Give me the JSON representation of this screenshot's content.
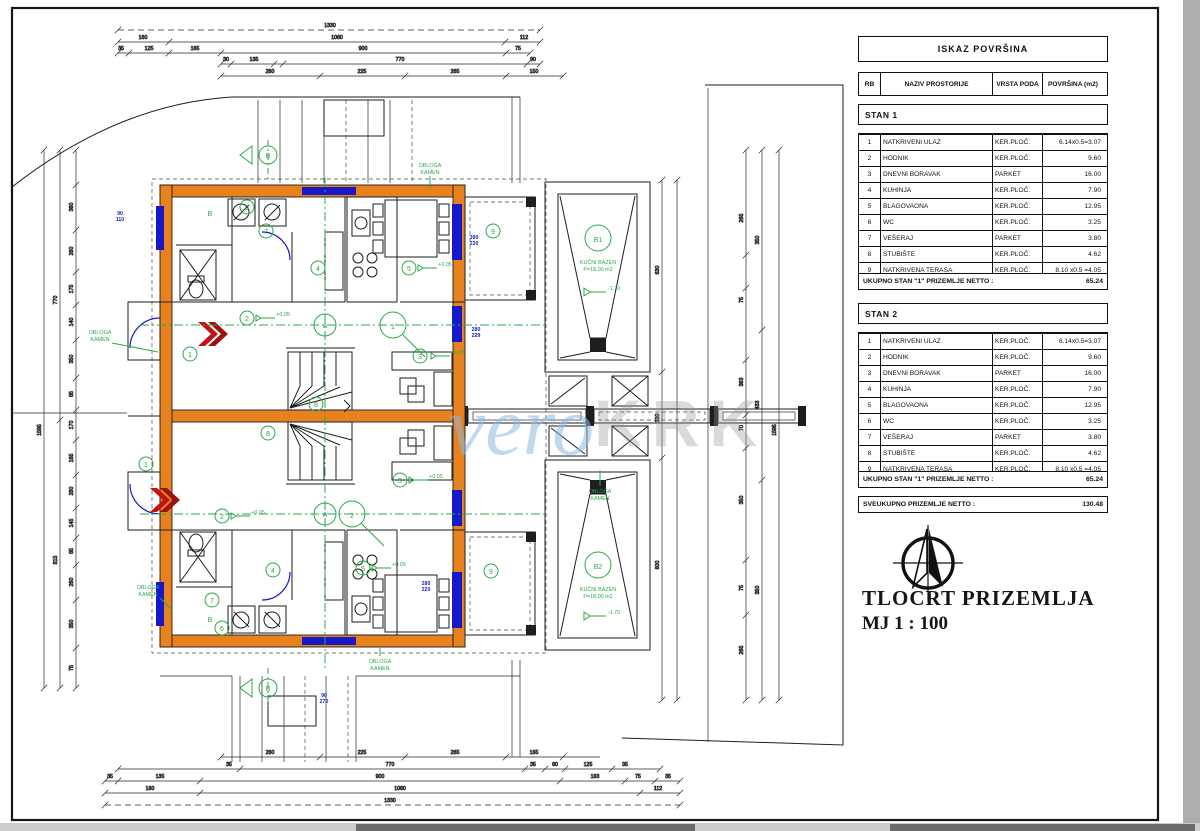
{
  "tables": {
    "title": "ISKAZ POVRŠINA",
    "columns": [
      "RB",
      "NAZIV PROSTORIJE",
      "VRSTA PODA",
      "POVRŠINA (m2)"
    ],
    "stan1": {
      "label": "STAN 1",
      "rows": [
        {
          "rb": "1",
          "name": "NATKRIVENI ULAZ",
          "floor": "KER.PLOČ.",
          "area": "6.14x0.5=3.07"
        },
        {
          "rb": "2",
          "name": "HODNIK",
          "floor": "KER.PLOČ.",
          "area": "9.60"
        },
        {
          "rb": "3",
          "name": "DNEVNI BORAVAK",
          "floor": "PARKET",
          "area": "16.00"
        },
        {
          "rb": "4",
          "name": "KUHINJA",
          "floor": "KER.PLOČ.",
          "area": "7.90"
        },
        {
          "rb": "5",
          "name": "BLAGOVAONA",
          "floor": "KER.PLOČ.",
          "area": "12.95"
        },
        {
          "rb": "6",
          "name": "WC",
          "floor": "KER.PLOČ.",
          "area": "3.25"
        },
        {
          "rb": "7",
          "name": "VEŠERAJ",
          "floor": "PARKET",
          "area": "3.80"
        },
        {
          "rb": "8",
          "name": "STUBIŠTE",
          "floor": "KER.PLOČ.",
          "area": "4.62"
        },
        {
          "rb": "9",
          "name": "NATKRIVENA TERASA",
          "floor": "KER.PLOČ.",
          "area": "8.10 x0.5 =4.05"
        }
      ],
      "total_label": "UKUPNO STAN \"1\" PRIZEMLJE NETTO :",
      "total": "65.24"
    },
    "stan2": {
      "label": "STAN 2",
      "rows": [
        {
          "rb": "1",
          "name": "NATKRIVENI ULAZ",
          "floor": "KER.PLOČ.",
          "area": "6.14x0.5=3.07"
        },
        {
          "rb": "2",
          "name": "HODNIK",
          "floor": "KER.PLOČ.",
          "area": "9.60"
        },
        {
          "rb": "3",
          "name": "DNEVNI BORAVAK",
          "floor": "PARKET",
          "area": "16.00"
        },
        {
          "rb": "4",
          "name": "KUHINJA",
          "floor": "KER.PLOČ.",
          "area": "7.90"
        },
        {
          "rb": "5",
          "name": "BLAGOVAONA",
          "floor": "KER.PLOČ.",
          "area": "12.95"
        },
        {
          "rb": "6",
          "name": "WC",
          "floor": "KER.PLOČ.",
          "area": "3.25"
        },
        {
          "rb": "7",
          "name": "VEŠERAJ",
          "floor": "PARKET",
          "area": "3.80"
        },
        {
          "rb": "8",
          "name": "STUBIŠTE",
          "floor": "KER.PLOČ.",
          "area": "4.62"
        },
        {
          "rb": "9",
          "name": "NATKRIVENA TERASA",
          "floor": "KER.PLOČ.",
          "area": "8.10 x0.5 =4.05"
        }
      ],
      "total_label": "UKUPNO STAN \"1\" PRIZEMLJE NETTO :",
      "total": "65.24"
    },
    "grand_label": "SVEUKUPNO PRIZEMLJE NETTO :",
    "grand": "130.48"
  },
  "titleblock": {
    "line1": "TLOCRT PRIZEMLJA",
    "line2": "MJ 1 : 100"
  },
  "watermark": {
    "p1": "vero",
    "p2": "KRK"
  },
  "plan": {
    "pool1": {
      "tag": "B1",
      "l1": "KUĆNI BAZEN",
      "l2": "P=18.00 m2"
    },
    "pool2": {
      "tag": "B2",
      "l1": "KUĆNI BAZEN",
      "l2": "P=18.00 m2"
    },
    "stone": {
      "l1": "OBLOGA",
      "l2": "KAMEN"
    },
    "rooms": [
      "1",
      "2",
      "3",
      "4",
      "5",
      "6",
      "7",
      "8",
      "9"
    ],
    "sec": {
      "a": "A",
      "b": "B",
      "s1": "1",
      "s2": "2"
    },
    "boiler": "B",
    "elev_floor": "+0.05",
    "elev_pool": "-1.70"
  },
  "dims": {
    "t": [
      "1330",
      "160",
      "1060",
      "112",
      "35",
      "125",
      "165",
      "900",
      "75",
      "30",
      "135",
      "770",
      "90",
      "260",
      "225",
      "265",
      "150"
    ],
    "bo": [
      "260",
      "225",
      "265",
      "165",
      "35",
      "770",
      "35",
      "60",
      "125",
      "35",
      "35",
      "135",
      "900",
      "163",
      "75",
      "35",
      "160",
      "1060",
      "112",
      "1330"
    ],
    "le": [
      "1595",
      "770",
      "815",
      "360",
      "260",
      "175",
      "140",
      "350",
      "85",
      "170",
      "165",
      "280",
      "145",
      "85",
      "260",
      "350",
      "75"
    ],
    "ri": [
      "265",
      "75",
      "363",
      "70",
      "350",
      "75",
      "265",
      "350",
      "433",
      "350",
      "1595"
    ],
    "mi": [
      "630",
      "130",
      "600"
    ],
    "bl": [
      [
        "90",
        "110"
      ],
      [
        "390",
        "230"
      ],
      [
        "280",
        "229"
      ],
      [
        "280",
        "220"
      ],
      [
        "90",
        "270"
      ]
    ]
  }
}
